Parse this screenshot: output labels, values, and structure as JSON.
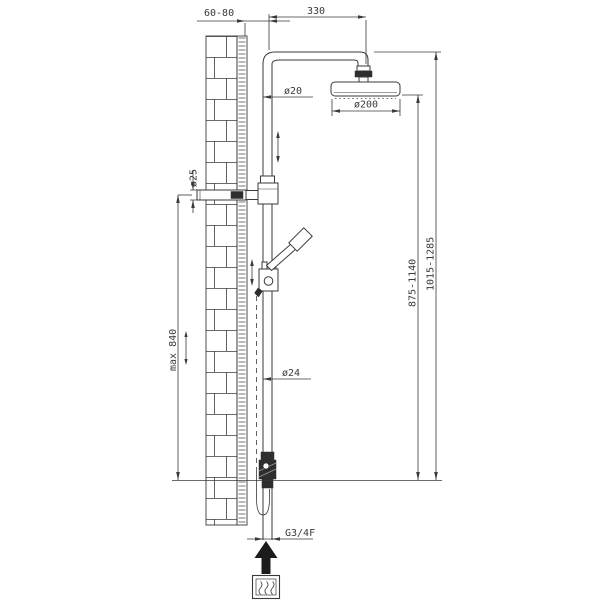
{
  "drawing": {
    "kind": "shower-column-installation-diagram",
    "background": "#ffffff",
    "line_color": "#3a3a3a",
    "dark_fill_color": "#2e2e2e",
    "labels": {
      "wall_offset": "60-80",
      "arm_length": "330",
      "upper_pipe_diameter": "ø20",
      "head_diameter": "ø200",
      "wall_bar_diameter": "ø25",
      "height_to_head_range": "875-1140",
      "total_height_range": "1015-1285",
      "slide_max_height": "max 840",
      "lower_pipe_diameter": "ø24",
      "inlet_thread": "G3/4F"
    },
    "icons": {
      "water_supply": "up-arrow-icon",
      "hot_water": "wavy-lines-icon"
    }
  }
}
